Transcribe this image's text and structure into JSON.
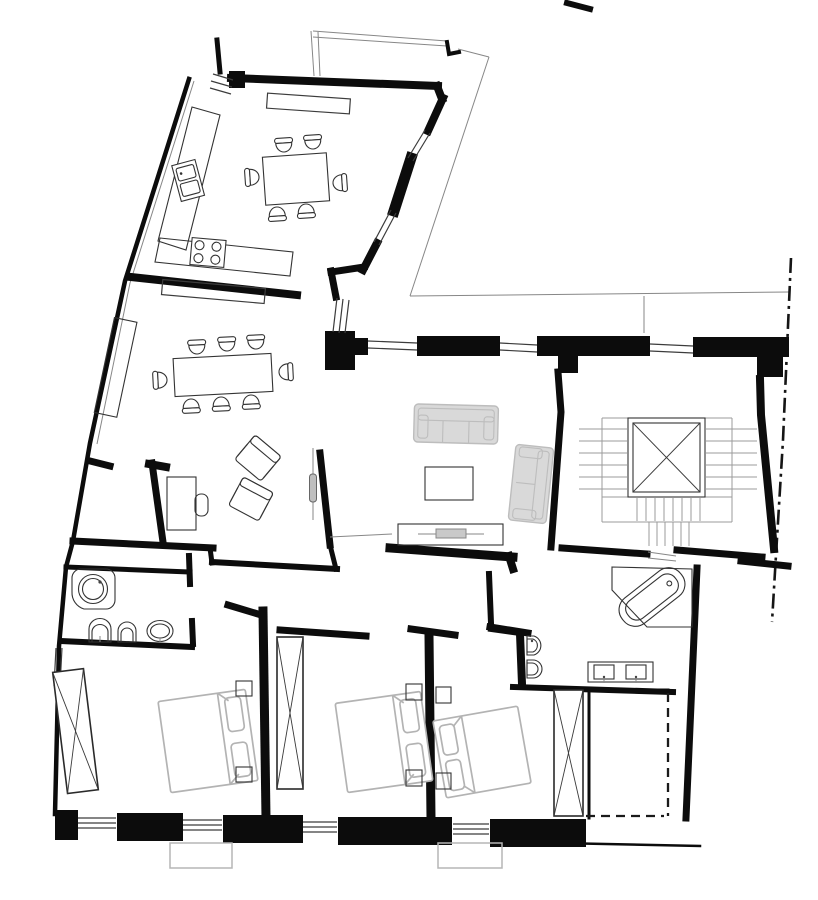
{
  "meta": {
    "title": "Apartment floor plan",
    "type": "architectural plan, top view, black and white line drawing",
    "description": "Black-and-white apartment floor plan: angled kitchen wing with dining table, long dining room with eight chairs, study with desk and two armchairs, living room with two grey sofas and coffee table, central stairwell with elevator shaft marked with an X, two bathrooms, three bedrooms with grey double beds and X-marked wardrobes, dashed walk-in closet, inner courtyard outline and dash-dot property boundary on the right, balconies along the bottom."
  },
  "palette": {
    "background": "#ffffff",
    "wall": "#0c0c0c",
    "thin": "#3c3c3c",
    "light": "#878787",
    "furn": "#333333",
    "gray_fill": "#d9d9d9",
    "gray_stroke": "#bdbdbd",
    "bed": "#b3b3b3",
    "balcony": "#b5b5b5"
  },
  "labels": {
    "plan": "Apartment floor plan",
    "kitchen": "Kitchen",
    "dining": "Dining room",
    "study": "Study / sitting area",
    "living": "Living room",
    "stairwell": "Stairwell with elevator",
    "bathroom1": "Bathroom 1",
    "bathroom2": "Bathroom 2",
    "bedroom1": "Bedroom 1",
    "bedroom2": "Bedroom 2",
    "bedroom3": "Bedroom 3",
    "closet": "Walk-in closet (dashed)",
    "courtyard": "Inner courtyard",
    "boundary": "Property boundary (dash-dot)",
    "balconies": "Balconies"
  },
  "inventory": {
    "rooms": [
      "kitchen",
      "dining room",
      "study / sitting area",
      "living room",
      "entrance hall",
      "corridor",
      "bathroom 1",
      "bathroom 2",
      "bedroom 1",
      "bedroom 2",
      "bedroom 3",
      "walk-in closet (dashed)",
      "stairwell with elevator",
      "inner courtyard",
      "balconies"
    ],
    "furniture": [
      {
        "name": "kitchen table",
        "qty": 1,
        "chairs": 6
      },
      {
        "name": "kitchen counter with double sink",
        "qty": 1
      },
      {
        "name": "cooktop with 4 burners",
        "qty": 1
      },
      {
        "name": "dining table",
        "qty": 1,
        "chairs": 8
      },
      {
        "name": "sideboard",
        "qty": 1
      },
      {
        "name": "wall cabinet / radiator strip",
        "qty": 2
      },
      {
        "name": "desk with chair",
        "qty": 1
      },
      {
        "name": "armchair",
        "qty": 2
      },
      {
        "name": "sofa 3-seat",
        "qty": 1
      },
      {
        "name": "sofa 2-seat",
        "qty": 1
      },
      {
        "name": "coffee table",
        "qty": 1
      },
      {
        "name": "console with radiator",
        "qty": 1
      },
      {
        "name": "corner shower",
        "qty": 1
      },
      {
        "name": "corner bathtub",
        "qty": 1
      },
      {
        "name": "toilet",
        "qty": 2
      },
      {
        "name": "bidet",
        "qty": 2
      },
      {
        "name": "washbasin",
        "qty": 1
      },
      {
        "name": "double washbasin vanity",
        "qty": 1
      },
      {
        "name": "double bed",
        "qty": 3
      },
      {
        "name": "nightstand",
        "qty": 6
      },
      {
        "name": "wardrobe (X symbol)",
        "qty": 3
      },
      {
        "name": "elevator shaft (X symbol)",
        "qty": 1
      }
    ],
    "symbols": {
      "x_box": "wardrobe or elevator shaft",
      "dash_dot_line": "property boundary",
      "dashed_line": "projected partition / closet",
      "double_thin_lines": "window",
      "gray_outline_rect": "balcony"
    }
  }
}
